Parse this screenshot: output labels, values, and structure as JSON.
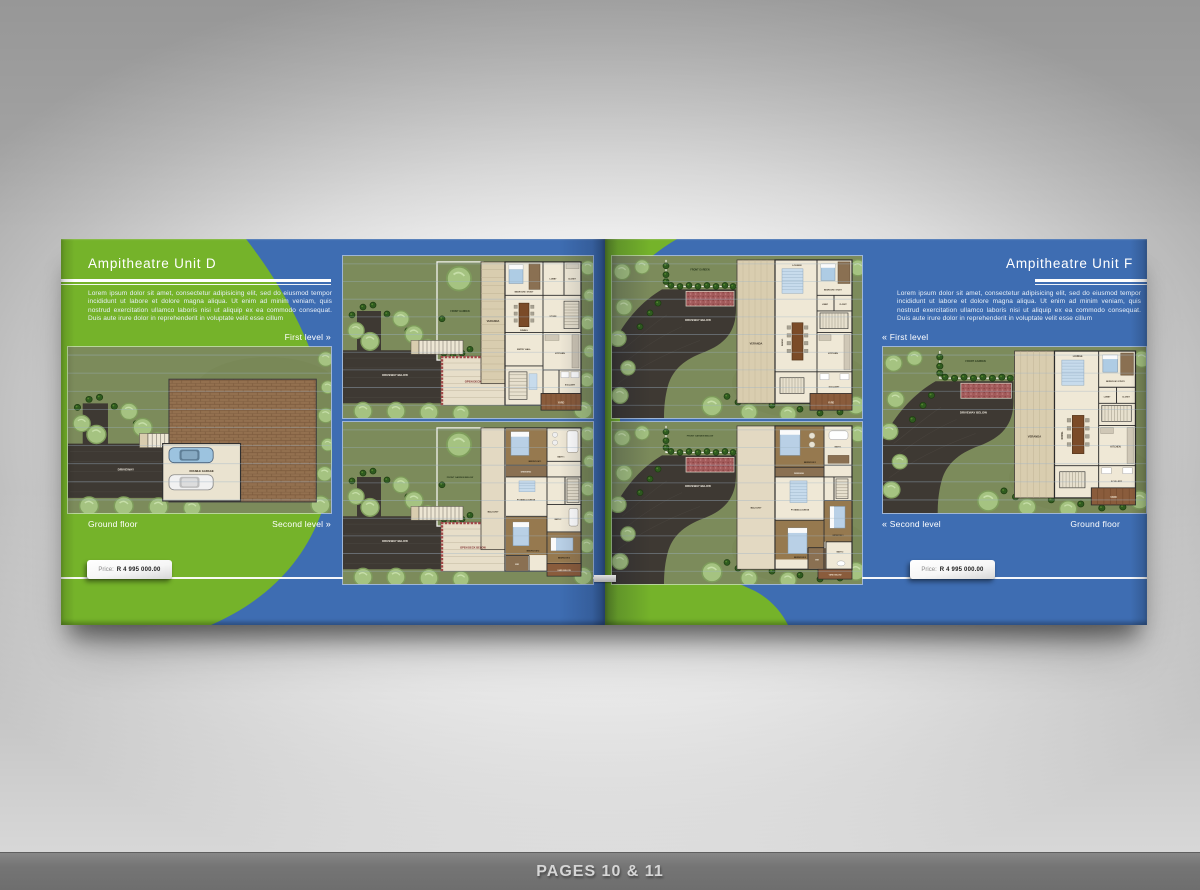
{
  "window": {
    "footer_caption": "PAGES 10 & 11"
  },
  "colors": {
    "accent_green": "#75B32A",
    "page_blue": "#3E6DB2",
    "lawn_green": "#7C8B5B",
    "driveway": "#3E3933"
  },
  "left_page": {
    "title": "Ampitheatre Unit D",
    "description": "Lorem ipsum dolor sit amet, consectetur adipisicing elit, sed do eiusmod tempor incididunt ut labore et dolore magna aliqua. Ut enim ad minim veniam, quis nostrud exercitation ullamco laboris nisi ut aliquip ex ea commodo consequat. Duis aute irure dolor in reprehenderit in voluptate velit esse cillum",
    "first_level_label": "First level",
    "first_level_arrow": "»",
    "second_level_label": "Second level",
    "second_level_arrow": "»",
    "ground_floor_label": "Ground floor",
    "price_label": "Price:",
    "price_value": "R 4 995 000.00"
  },
  "right_page": {
    "title": "Ampitheatre Unit F",
    "description": "Lorem ipsum dolor sit amet, consectetur adipisicing elit, sed do eiusmod tempor incididunt ut labore et dolore magna aliqua. Ut enim ad minim veniam, quis nostrud exercitation ullamco laboris nisi ut aliquip ex ea commodo consequat. Duis aute irure dolor in reprehenderit in voluptate velit esse cillum",
    "first_level_label": "First level",
    "first_level_arrow": "«",
    "second_level_label": "Second level",
    "second_level_arrow": "«",
    "ground_floor_label": "Ground floor",
    "price_label": "Price:",
    "price_value": "R 4 995 000.00"
  },
  "plan_labels": {
    "driveway": "DRIVEWAY",
    "driveway_below": "DRIVEWAY BELOW",
    "double_garage": "DOUBLE GARAGE",
    "front_garden": "FRONT GARDEN",
    "front_garden_below": "FRONT GARDEN BELOW",
    "veranda": "VERANDA",
    "open_deck": "OPEN DECK",
    "open_deck_below": "OPEN DECK BELOW",
    "entry_hall": "ENTRY HALL",
    "kitchen": "KITCHEN",
    "store": "STORE",
    "lobby": "LOBBY",
    "closet": "CLOSET",
    "bedroom_study": "BEDROOM / STUDY",
    "dining": "DINING",
    "scullery": "SCULLERY",
    "yard": "YARD",
    "yard_below": "YARD BELOW",
    "lounge": "LOUNGE",
    "balcony": "BALCONY",
    "pyjama_lounge": "PYJAMA LOUNGE",
    "dressing": "DRESSING",
    "bedroom1": "BEDROOM 1",
    "bedroom2": "BEDROOM 2",
    "bedroom3": "BEDROOM 3",
    "bath1": "BATH 1",
    "bath2": "BATH 2",
    "wir": "WIR"
  }
}
